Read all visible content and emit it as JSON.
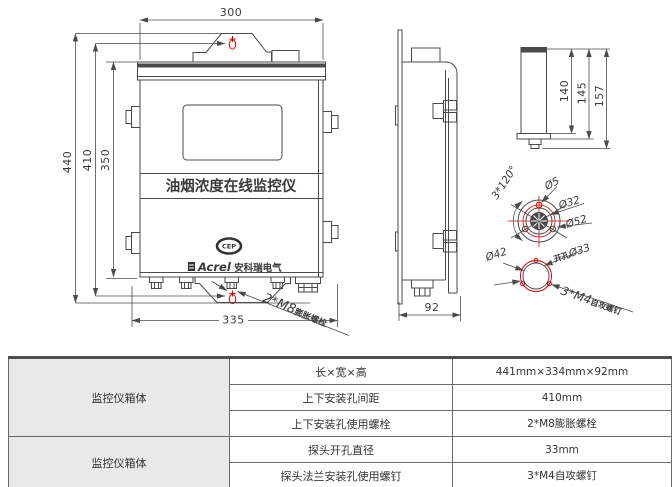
{
  "drawing": {
    "front_view": {
      "dim_width_top": "300",
      "dim_height_total": "440",
      "dim_hole_spacing": "410",
      "dim_body_height": "350",
      "dim_width_bottom": "335",
      "device_title": "油烟浓度在线监控仪",
      "logo_text": "CEP",
      "brand_name": "Acrel",
      "brand_cn": " 安科瑞电气",
      "anchor_label_big": "2*M8",
      "anchor_label_small": "膨胀螺栓"
    },
    "side_view": {
      "dim_depth": "92"
    },
    "probe_view": {
      "dim_probe_body": "140",
      "dim_probe_flange": "145",
      "dim_probe_total": "157"
    },
    "flange_view": {
      "angle_label": "3*120°",
      "dia_hole": "Ø5",
      "dia_inner": "Ø32",
      "dia_outer": "Ø52"
    },
    "hole_view": {
      "dia_flange": "Ø42",
      "hole_prefix": "开孔",
      "hole_dia": "Ø33",
      "screw_label_big": "3*M4",
      "screw_label_small": "自攻螺钉"
    }
  },
  "table": {
    "groups": [
      {
        "label": "监控仪箱体",
        "rows": [
          {
            "param": "长×宽×高",
            "value": "441mm×334mm×92mm"
          },
          {
            "param": "上下安装孔间距",
            "value": "410mm"
          },
          {
            "param": "上下安装孔使用螺栓",
            "value": "2*M8膨胀螺栓"
          }
        ]
      },
      {
        "label": "监控仪箱体",
        "rows": [
          {
            "param": "探头开孔直径",
            "value": "33mm"
          },
          {
            "param": "探头法兰安装孔使用螺钉",
            "value": "3*M4自攻螺钉"
          }
        ]
      }
    ]
  },
  "colors": {
    "line": "#4a4a4a",
    "red": "#e00000",
    "table_gray": "#e9e9e9"
  }
}
